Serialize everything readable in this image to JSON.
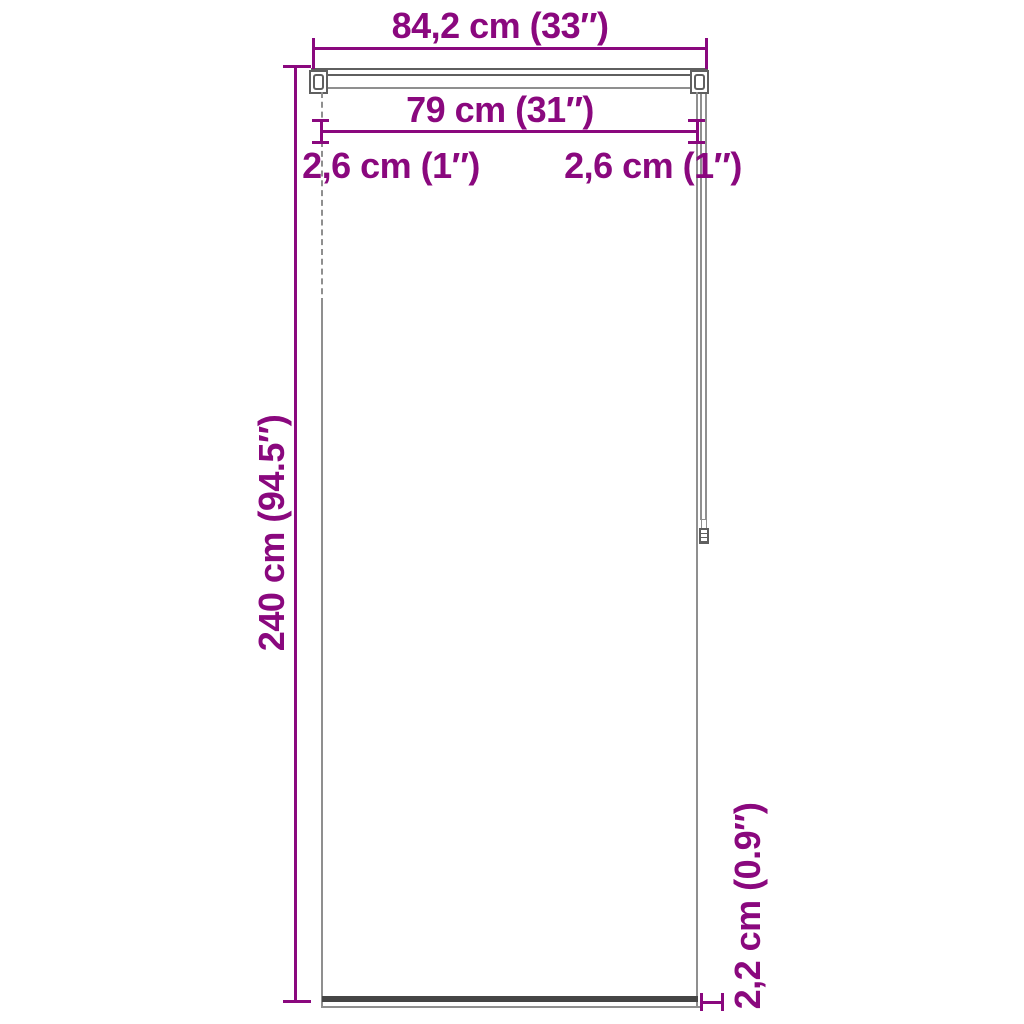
{
  "diagram": {
    "type": "product-dimension-diagram",
    "product": "roller blind"
  },
  "labels": {
    "total_width": "84,2 cm (33″)",
    "inner_width": "79 cm (31″)",
    "left_inset": "2,6 cm (1″)",
    "right_inset": "2,6 cm (1″)",
    "height": "240 cm (94.5″)",
    "bottom_bar_height": "2,2 cm (0.9″)"
  },
  "colors": {
    "dimension_text": "#8A087E",
    "outline_light": "#8f8f8f",
    "outline_mid": "#5f5f5f",
    "outline_dark": "#454545",
    "background": "#ffffff"
  }
}
